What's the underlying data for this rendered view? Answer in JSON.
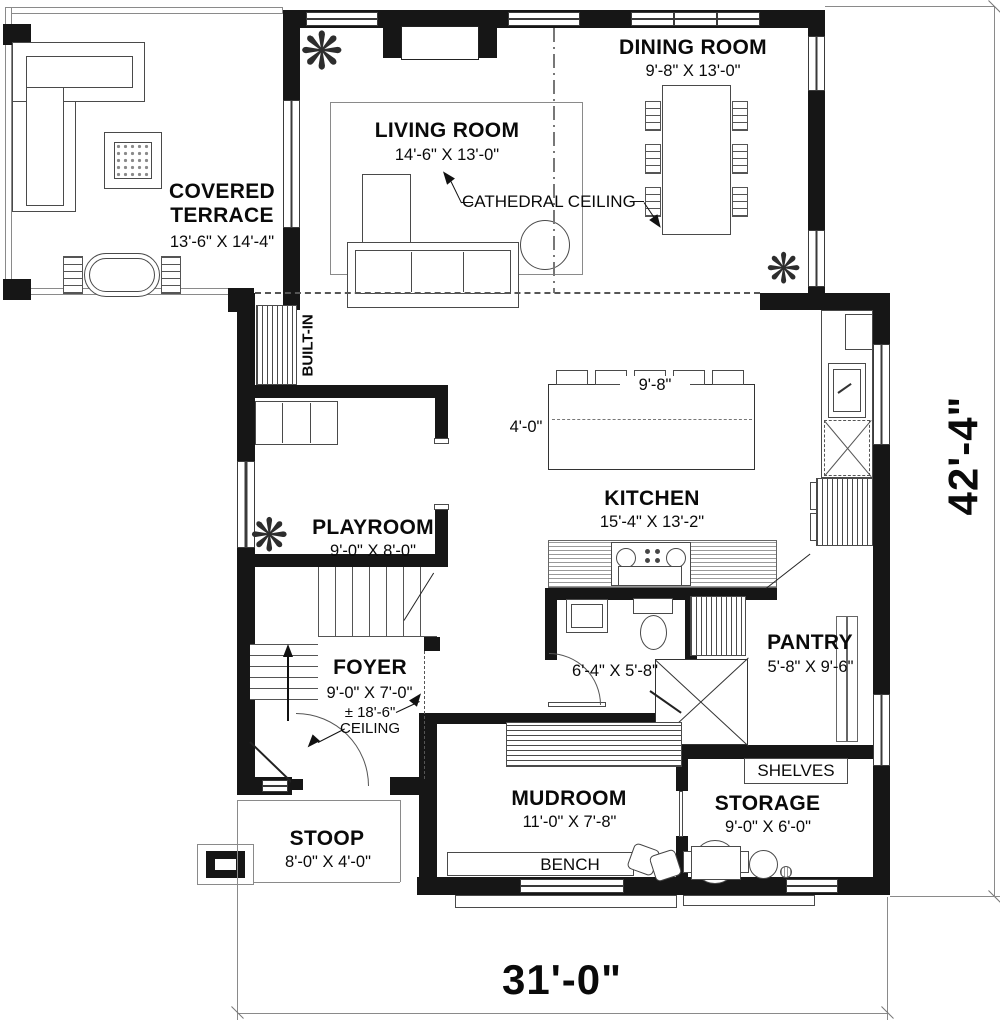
{
  "rooms": {
    "terrace": {
      "name": "COVERED TERRACE",
      "dims": "13'-6\" X 14'-4\""
    },
    "living": {
      "name": "LIVING ROOM",
      "dims": "14'-6\" X 13'-0\""
    },
    "dining": {
      "name": "DINING ROOM",
      "dims": "9'-8\" X 13'-0\""
    },
    "kitchen": {
      "name": "KITCHEN",
      "dims": "15'-4\" X 13'-2\""
    },
    "playroom": {
      "name": "PLAYROOM",
      "dims": "9'-0\" X 8'-0\""
    },
    "foyer": {
      "name": "FOYER",
      "dims": "9'-0\" X 7'-0\"",
      "ceiling_height": "± 18'-6\"",
      "ceiling_label": "CEILING"
    },
    "powder": {
      "dims": "6'-4\" X 5'-8\""
    },
    "pantry": {
      "name": "PANTRY",
      "dims": "5'-8\" X 9'-6\""
    },
    "mudroom": {
      "name": "MUDROOM",
      "dims": "11'-0\" X 7'-8\""
    },
    "storage": {
      "name": "STORAGE",
      "dims": "9'-0\" X 6'-0\""
    },
    "stoop": {
      "name": "STOOP",
      "dims": "8'-0\" X 4'-0\""
    }
  },
  "annotations": {
    "cathedral_ceiling": "CATHEDRAL CEILING",
    "built_in": "BUILT-IN",
    "bench": "BENCH",
    "shelves": "SHELVES",
    "island_width": "9'-8\"",
    "island_depth": "4'-0\""
  },
  "dimensions": {
    "overall_width": "31'-0\"",
    "overall_depth": "42'-4\""
  },
  "icons": {
    "plant": "❋"
  },
  "colors": {
    "wall": "#161616",
    "line": "#8a8a8a",
    "background": "#ffffff"
  }
}
